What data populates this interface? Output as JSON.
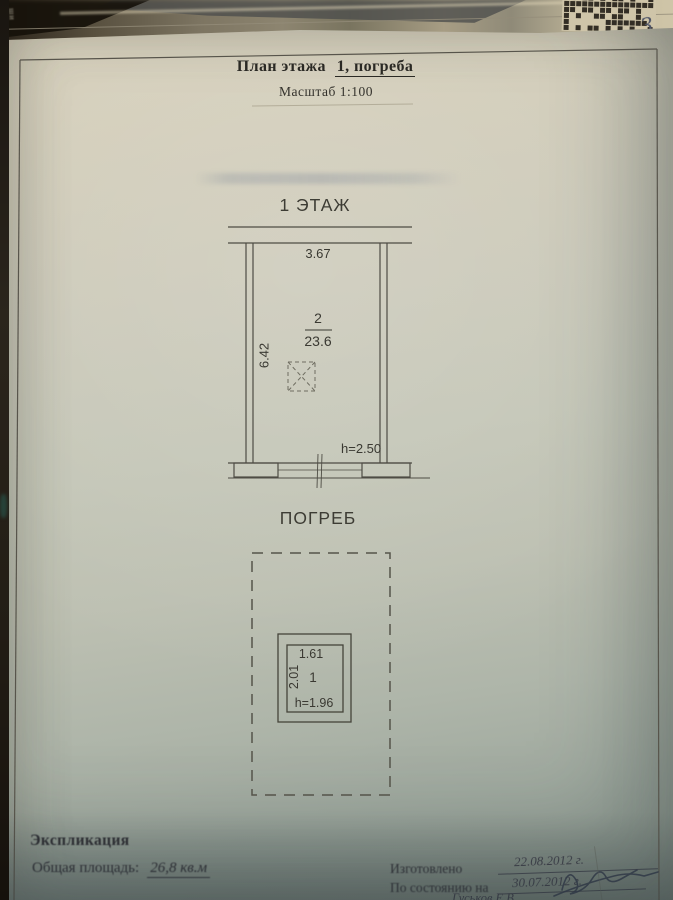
{
  "photo": {
    "page_number": "3",
    "edge_fragments": [
      "1991",
      "под",
      "ши"
    ]
  },
  "title": {
    "prefix": "План этажа",
    "object": "1, погреба",
    "scale": "Масштаб 1:100"
  },
  "floor1": {
    "heading": "1 ЭТАЖ",
    "top_dim": "3.67",
    "side_dim": "6.42",
    "room_number": "2",
    "room_area": "23.6",
    "height_note": "h=2.50"
  },
  "cellar": {
    "heading": "ПОГРЕБ",
    "top_dim": "1.61",
    "side_dim": "2.01",
    "room_number": "1",
    "height_note": "h=1.96"
  },
  "explication": {
    "heading": "Экспликация",
    "total_area_label": "Общая площадь:",
    "total_area_value": "26,8 кв.м"
  },
  "footer": {
    "made_label": "Изготовлено",
    "made_date": "22.08.2012 г.",
    "as_of_label": "По состоянию на",
    "as_of_date": "30.07.2012 г.",
    "signature_name": "Гуськов Е.В"
  },
  "colors": {
    "ink": "#2a2924",
    "plan_line": "#4e4c44",
    "pen_blue": "#3a3f52"
  }
}
